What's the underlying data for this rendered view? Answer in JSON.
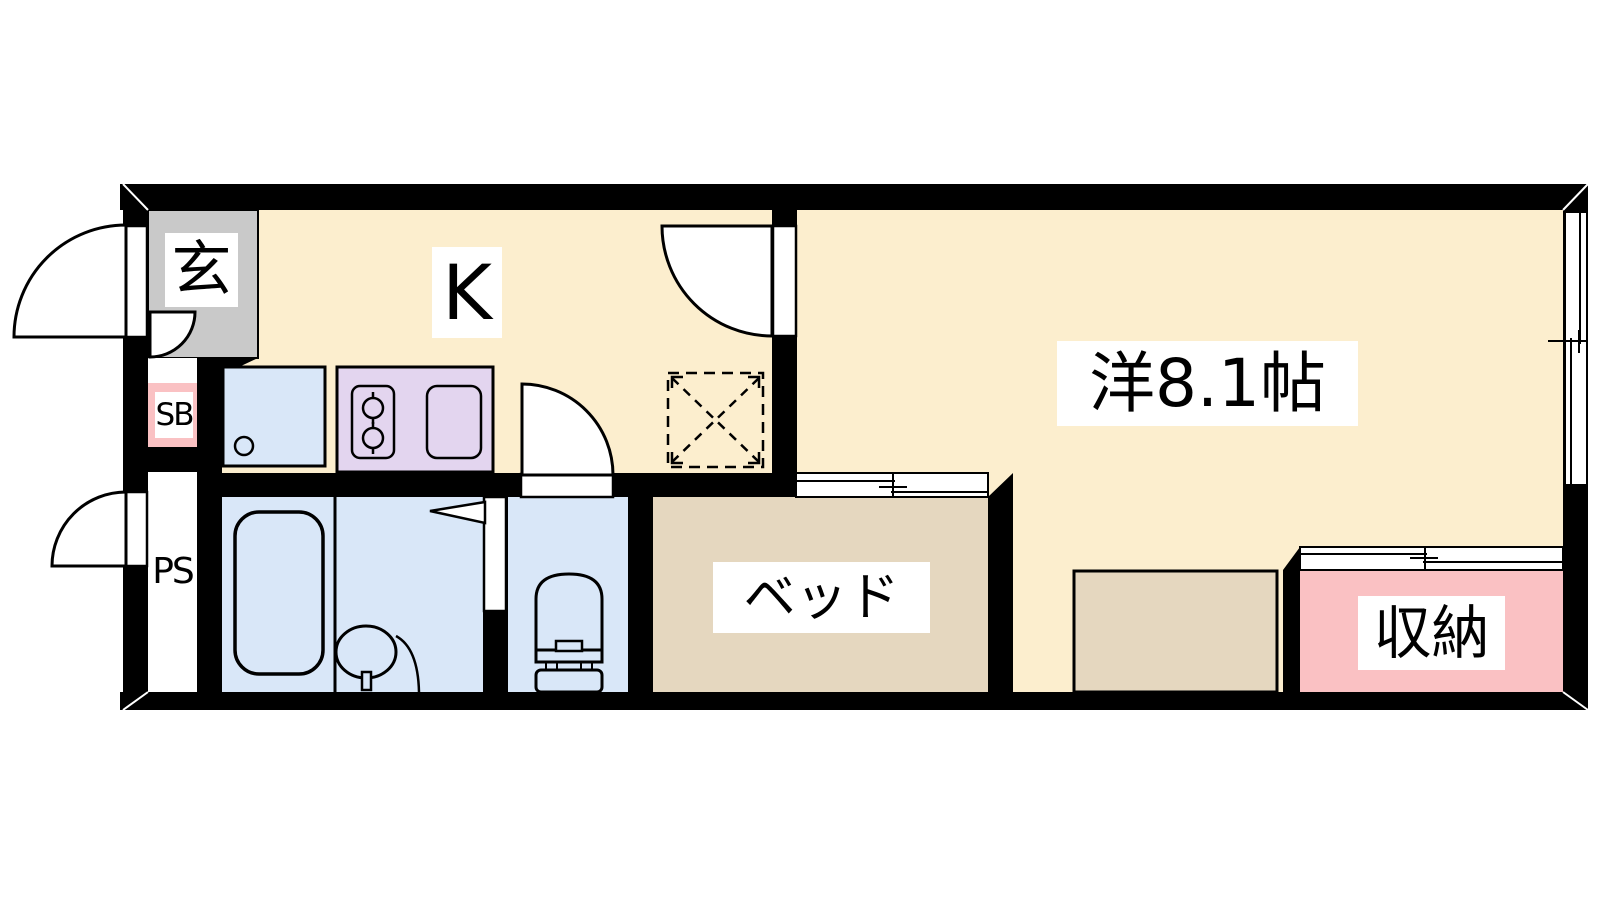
{
  "plan": {
    "type": "apartment-floor-plan",
    "layout_name": "1K",
    "rooms": {
      "genkan": {
        "label": "玄"
      },
      "shoe_box": {
        "label": "SB"
      },
      "pipe_space": {
        "label": "PS"
      },
      "kitchen": {
        "label": "K"
      },
      "bed": {
        "label": "ベッド"
      },
      "western_room": {
        "label": "洋8.1帖",
        "size_tatami": 8.1
      },
      "storage": {
        "label": "収納"
      }
    },
    "colors": {
      "wall": "#000000",
      "room_floor": "#fceece",
      "genkan_floor": "#c9c9c9",
      "wet_area_floor": "#d9e7f8",
      "stove_counter": "#e3d5ef",
      "bed_area": "#e5d7bf",
      "storage_area": "#fac1c3",
      "label_background": "#ffffff",
      "outline": "#000000"
    }
  }
}
